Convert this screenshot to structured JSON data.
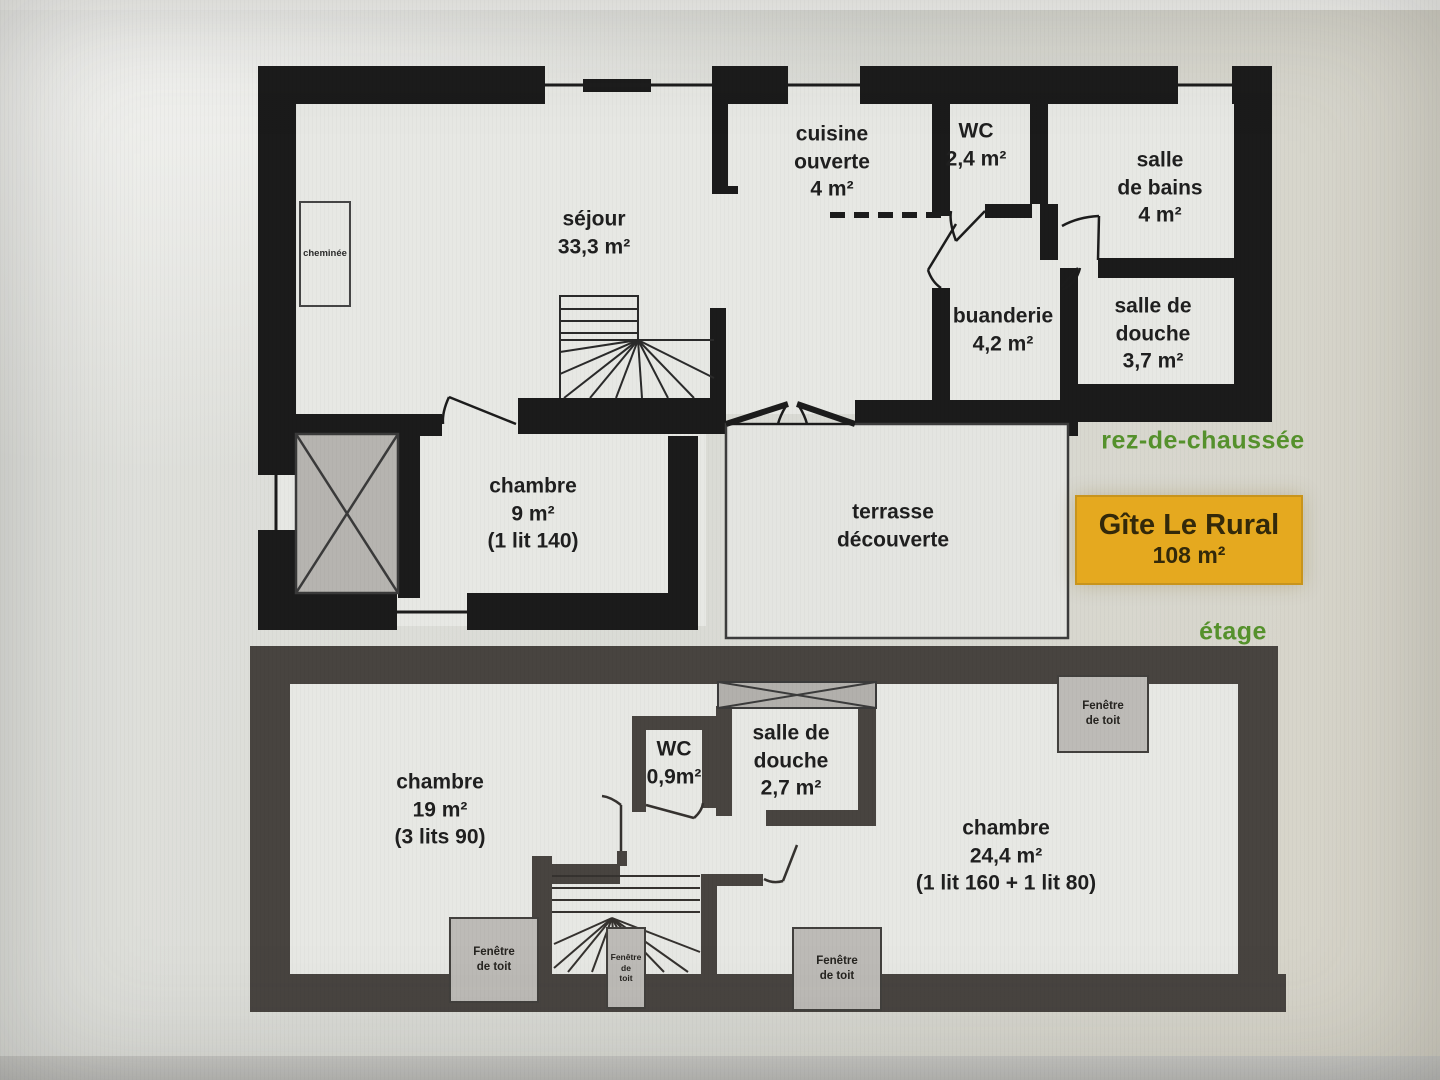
{
  "plan": {
    "legend": {
      "title": "Gîte Le Rural",
      "area": "108 m²"
    },
    "rdc": {
      "floor_label": "rez-de-chaussée",
      "rooms": {
        "sejour": [
          "séjour",
          "33,3 m²"
        ],
        "cuisine": [
          "cuisine",
          "ouverte",
          "4 m²"
        ],
        "wc": [
          "WC",
          "2,4 m²"
        ],
        "salle_de_bains": [
          "salle",
          "de bains",
          "4 m²"
        ],
        "buanderie": [
          "buanderie",
          "4,2 m²"
        ],
        "salle_de_douche": [
          "salle de",
          "douche",
          "3,7 m²"
        ],
        "chambre": [
          "chambre",
          "9 m²",
          "(1 lit 140)"
        ],
        "terrasse": [
          "terrasse",
          "découverte"
        ],
        "cheminee": [
          "cheminée"
        ]
      }
    },
    "etage": {
      "floor_label": "étage",
      "rooms": {
        "chambre_19": [
          "chambre",
          "19 m²",
          "(3 lits 90)"
        ],
        "wc": [
          "WC",
          "0,9m²"
        ],
        "salle_de_douche": [
          "salle de",
          "douche",
          "2,7 m²"
        ],
        "chambre_24": [
          "chambre",
          "24,4 m²",
          "(1 lit 160 + 1 lit 80)"
        ]
      },
      "roof_window": [
        "Fenêtre",
        "de toit"
      ],
      "roof_window_stacked": [
        "Fenêtre",
        "de",
        "toit"
      ]
    },
    "colors": {
      "wall_ground_floor": "#1b1b1b",
      "wall_upper_floor": "#484440",
      "floor_label_green": "#55912c",
      "legend_yellow": "#e5a91f",
      "legend_text": "#33290a"
    }
  }
}
